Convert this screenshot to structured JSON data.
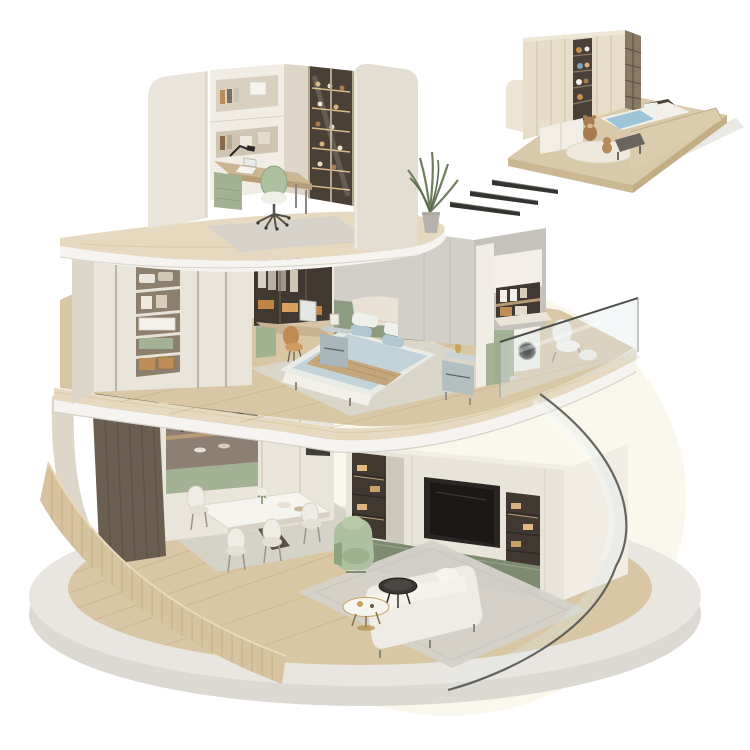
{
  "scene": {
    "alt": "Isometric cutaway render of a three-storey circular apartment model on a round concrete base: top-floor home office, middle-floor bedroom with walk-in wardrobe and glass-railed laundry balcony, ground-floor dining and living room behind curved glass, plus a detached kids bedroom module floating at the top right connected by three motion dashes",
    "objects": [
      "circular concrete base platform",
      "curved slatted wood fence",
      "ground-floor dining set with sideboard",
      "ground-floor living room with TV wall, sofa, armchair, coffee tables",
      "curved glass facade",
      "middle-floor bedroom with double bed and nightstands",
      "walk-in wardrobe with open shelving",
      "vanity desk with orange chair",
      "laundry balcony with washing machine and lounge chair",
      "top-floor study with desk, green swivel chair, bookshelves and display cabinet",
      "potted plant",
      "detached kids bedroom module with wardrobe wall, bed and teddy bears",
      "three motion dashes"
    ],
    "palette": {
      "background": "#ffffff",
      "backdrop_glow": "#faf8ec",
      "base_top": "#e9e6e2",
      "base_side": "#dcd9d3",
      "wood_floor": "#d9c6a4",
      "wood_plank_line": "#c4ad85",
      "ribbed_wall": "#d8c3a0",
      "ribbed_slat": "#c3ac83",
      "travertine": "#e6d9bf",
      "travertine_streak": "#d8c8a6",
      "fascia_white": "#f6f4f0",
      "cream_wall": "#eae5db",
      "cream_dark": "#ded7c9",
      "cream_bright": "#f1ede5",
      "grey_wall": "#d2cfc8",
      "grey_wall_dark": "#c5c2bb",
      "sage": "#a3b292",
      "sage_dark": "#7f8b71",
      "sage_chair": "#adc0a0",
      "dark_wood_panel": "#6b5d4f",
      "niche_dark": "#413931",
      "shelf_wood": "#b59a72",
      "warm_light": "#e8c893",
      "tv_screen": "#1b1917",
      "bed_blue": "#c2d4da",
      "pillow_blue": "#aec7d0",
      "bed_tan": "#c3a67c",
      "headboard_cream": "#e9e1d3",
      "white_soft": "#f3f0ea",
      "nightstand_grey": "#a9b6ba",
      "rug_grey": "#d5d2cb",
      "rug_light": "#dbd8d1",
      "chair_orange": "#c08b50",
      "glass_tint": "#dfeaec",
      "glass_edge": "#4c4c48",
      "wicker": "#bd8d55",
      "plant_green": "#6f7f5d",
      "pot_grey": "#b7b3ac",
      "teddy_brown": "#a97c4f",
      "inset_wood": "#d9c9ab",
      "inset_wall": "#e7ddc9",
      "inset_bookcase": "#8a7a64",
      "inset_blue": "#9ec4d8",
      "dash_dark": "#35332f",
      "marble_white": "#f6f4ef",
      "gold": "#c9a35c",
      "metal_grey": "#8b867e"
    }
  }
}
